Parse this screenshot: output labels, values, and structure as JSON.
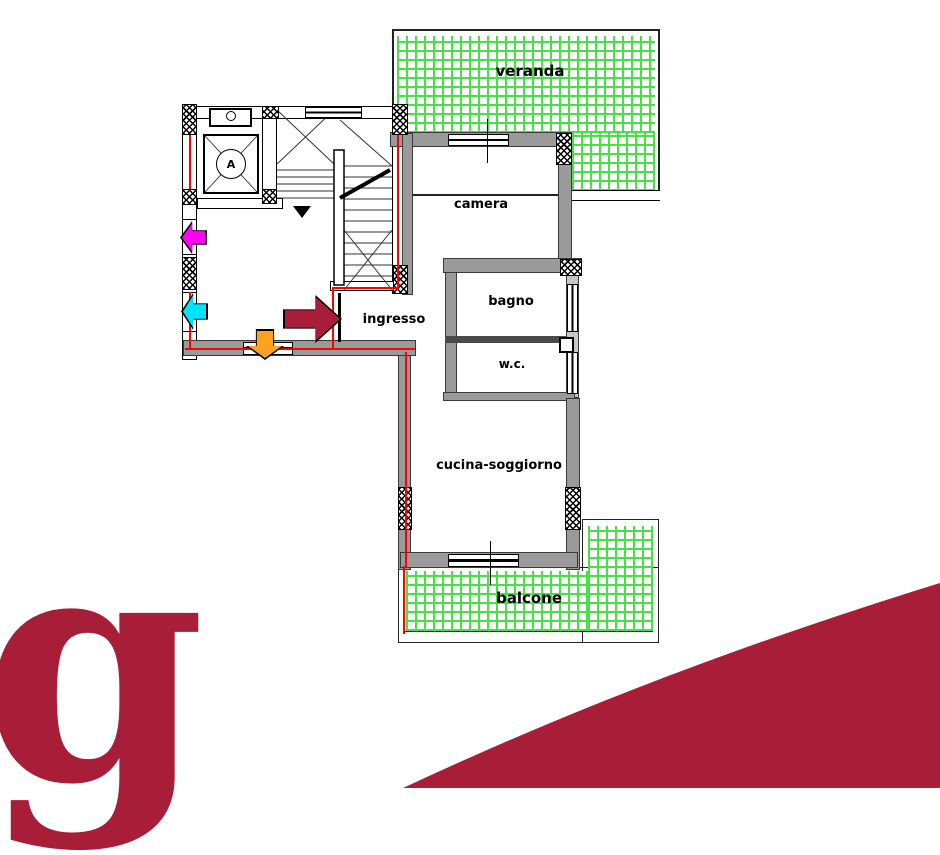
{
  "plan": {
    "rooms": [
      {
        "id": "veranda",
        "label": "veranda"
      },
      {
        "id": "camera",
        "label": "camera"
      },
      {
        "id": "bagno",
        "label": "bagno"
      },
      {
        "id": "wc",
        "label": "w.c."
      },
      {
        "id": "ingresso",
        "label": "ingresso"
      },
      {
        "id": "cucina_soggiorno",
        "label": "cucina-soggiorno"
      },
      {
        "id": "balcone",
        "label": "balcone"
      }
    ],
    "stairwell": {
      "lift_label": "A"
    },
    "legend_colors": {
      "tiled_outdoor_green": "#47e047",
      "wall_gray": "#9a9a9a",
      "apartment_outline_red": "#ff0000",
      "entrance_arrow": "#a81e38",
      "arrow_magenta": "#ff00ff",
      "arrow_cyan": "#00e5ff",
      "arrow_orange": "#ffa21f"
    }
  },
  "branding": {
    "logo_letter": "g",
    "brand_color": "#a81e38"
  }
}
